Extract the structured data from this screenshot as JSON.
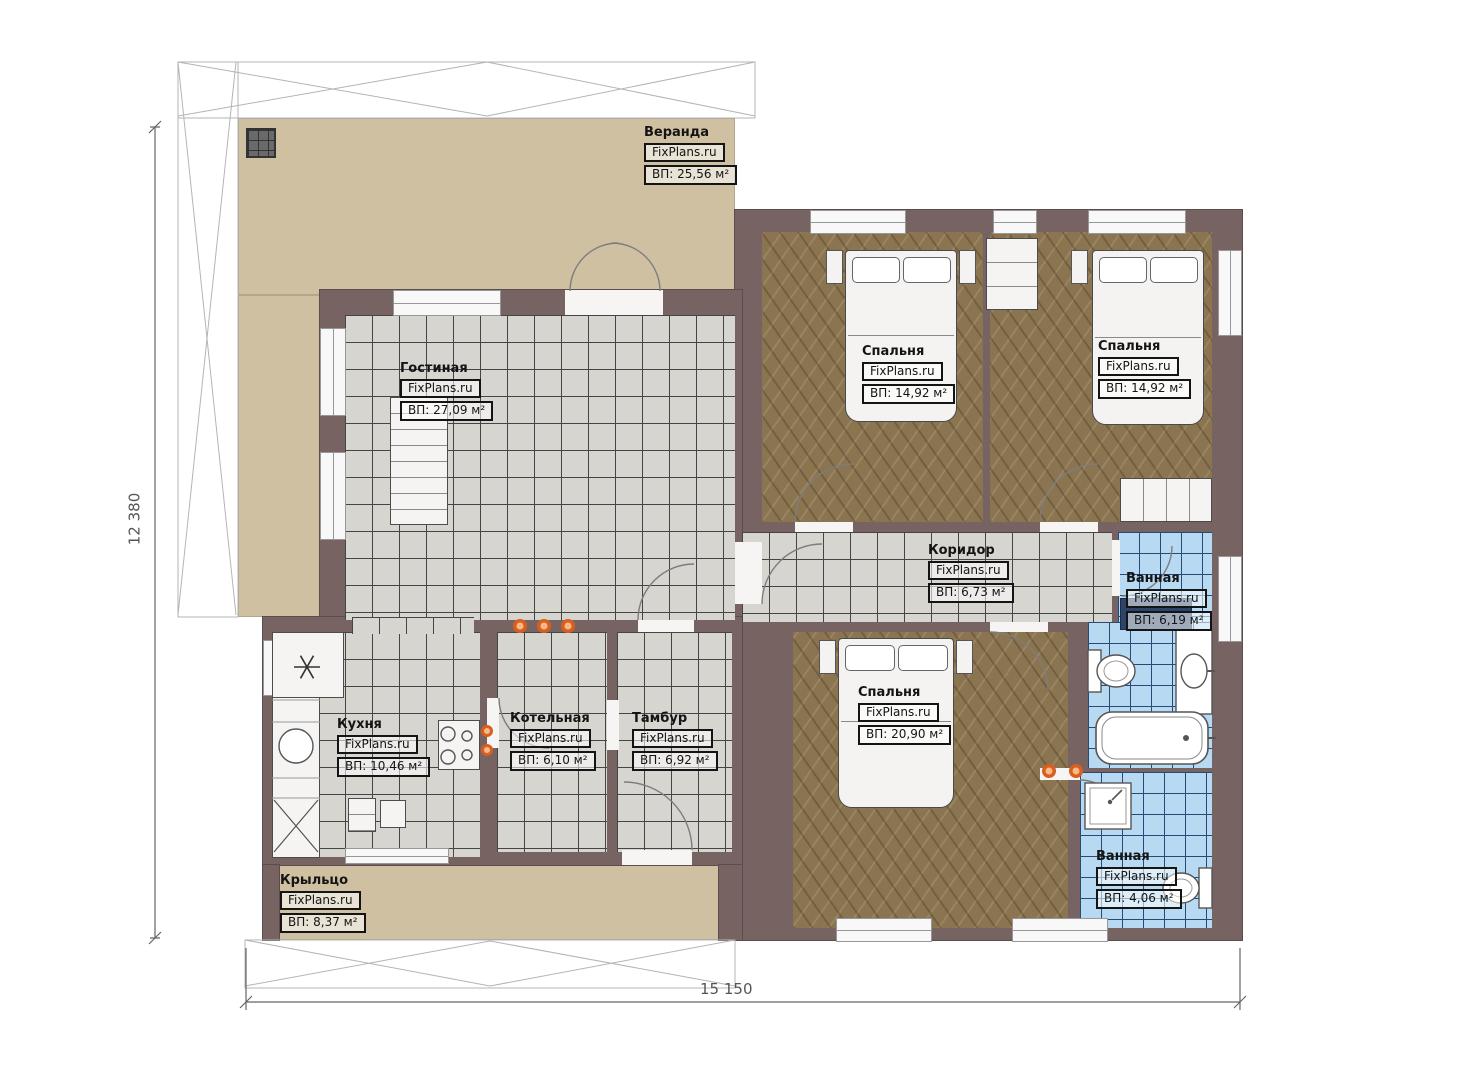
{
  "branding": {
    "vendor": "FixPlans.ru"
  },
  "dimensions": {
    "height_label": "12 380",
    "width_label": "15 150"
  },
  "rooms": [
    {
      "id": "veranda",
      "name": "Веранда",
      "vendor": "FixPlans.ru",
      "area": "ВП: 25,56 м²"
    },
    {
      "id": "gostinaya",
      "name": "Гостиная",
      "vendor": "FixPlans.ru",
      "area": "ВП: 27,09 м²"
    },
    {
      "id": "spalnya-1",
      "name": "Спальня",
      "vendor": "FixPlans.ru",
      "area": "ВП: 14,92 м²"
    },
    {
      "id": "spalnya-2",
      "name": "Спальня",
      "vendor": "FixPlans.ru",
      "area": "ВП: 14,92 м²"
    },
    {
      "id": "koridor",
      "name": "Коридор",
      "vendor": "FixPlans.ru",
      "area": "ВП: 6,73 м²"
    },
    {
      "id": "vannaya-1",
      "name": "Ванная",
      "vendor": "FixPlans.ru",
      "area": "ВП: 6,19 м²"
    },
    {
      "id": "spalnya-3",
      "name": "Спальня",
      "vendor": "FixPlans.ru",
      "area": "ВП: 20,90 м²"
    },
    {
      "id": "kuhnya",
      "name": "Кухня",
      "vendor": "FixPlans.ru",
      "area": "ВП: 10,46 м²"
    },
    {
      "id": "kotelnaya",
      "name": "Котельная",
      "vendor": "FixPlans.ru",
      "area": "ВП: 6,10 м²"
    },
    {
      "id": "tambur",
      "name": "Тамбур",
      "vendor": "FixPlans.ru",
      "area": "ВП: 6,92 м²"
    },
    {
      "id": "kryltso",
      "name": "Крыльцо",
      "vendor": "FixPlans.ru",
      "area": "ВП: 8,37 м²"
    },
    {
      "id": "vannaya-2",
      "name": "Ванная",
      "vendor": "FixPlans.ru",
      "area": "ВП: 4,06 м²"
    }
  ],
  "colors": {
    "wall": "#786363",
    "veranda": "#cfc0a2",
    "tile_gray": "#d7d5d0",
    "tile_blue": "#b7d9f2",
    "wood": "#8b7450",
    "spotlight": "#d95f1e"
  }
}
